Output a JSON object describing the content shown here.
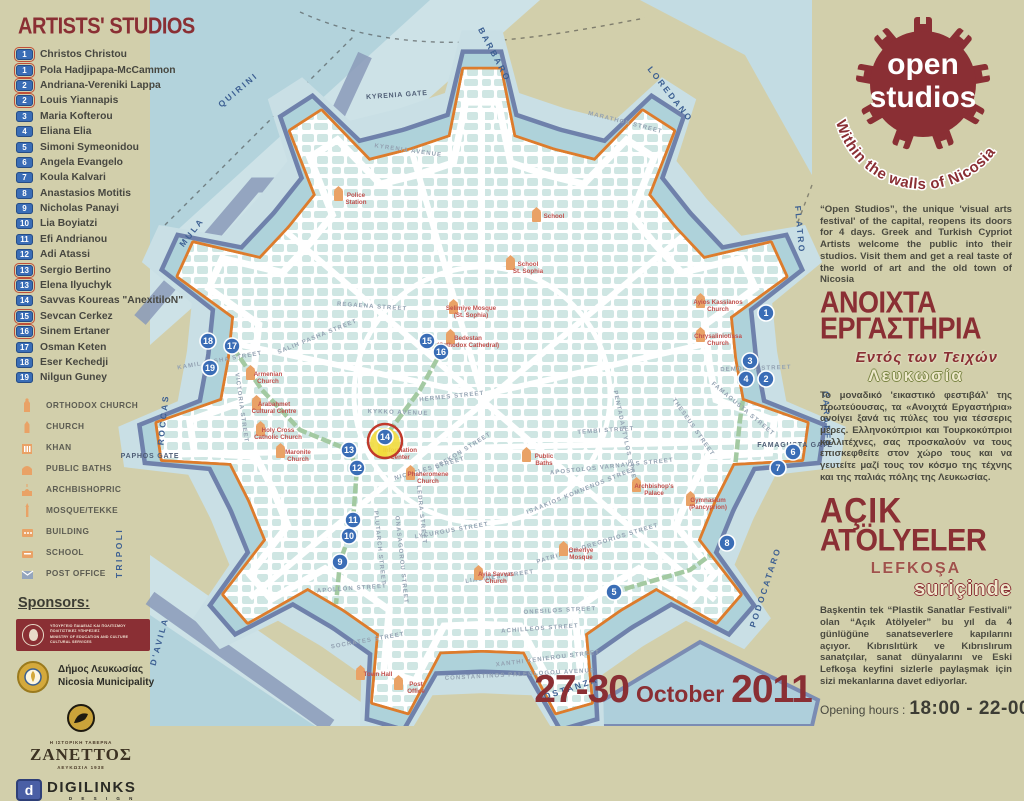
{
  "sidebar": {
    "title": "ARTISTS' STUDIOS",
    "studios": [
      {
        "num": "1",
        "name": "Christos Christou",
        "boxed": true
      },
      {
        "num": "1",
        "name": "Pola Hadjipapa-McCammon",
        "boxed": true
      },
      {
        "num": "2",
        "name": "Andriana-Vereniki Lappa",
        "boxed": true
      },
      {
        "num": "2",
        "name": "Louis Yiannapis",
        "boxed": true
      },
      {
        "num": "3",
        "name": "Maria Kofterou",
        "boxed": false
      },
      {
        "num": "4",
        "name": "Eliana Elia",
        "boxed": false
      },
      {
        "num": "5",
        "name": "Simoni Symeonidou",
        "boxed": false
      },
      {
        "num": "6",
        "name": "Angela  Evangelo",
        "boxed": false
      },
      {
        "num": "7",
        "name": "Koula Kalvari",
        "boxed": false
      },
      {
        "num": "8",
        "name": "Anastasios Motitis",
        "boxed": false
      },
      {
        "num": "9",
        "name": "Nicholas Panayi",
        "boxed": false
      },
      {
        "num": "10",
        "name": "Lia Boyiatzi",
        "boxed": false
      },
      {
        "num": "11",
        "name": "Efi Andrianou",
        "boxed": false
      },
      {
        "num": "12",
        "name": "Adi Atassi",
        "boxed": false
      },
      {
        "num": "13",
        "name": "Sergio Bertino",
        "boxed": true
      },
      {
        "num": "13",
        "name": "Elena Ilyuchyk",
        "boxed": true
      },
      {
        "num": "14",
        "name": "Savvas Koureas \"AnexitiloN\"",
        "boxed": false
      },
      {
        "num": "15",
        "name": "Sevcan Cerkez",
        "boxed": true
      },
      {
        "num": "16",
        "name": "Sinem Ertaner",
        "boxed": true
      },
      {
        "num": "17",
        "name": "Osman Keten",
        "boxed": false
      },
      {
        "num": "18",
        "name": "Eser Kechedji",
        "boxed": false
      },
      {
        "num": "19",
        "name": "Nilgun Guney",
        "boxed": false
      }
    ],
    "legend": [
      {
        "icon": "orthodox-church-icon",
        "label": "ORTHODOX CHURCH"
      },
      {
        "icon": "church-icon",
        "label": "CHURCH"
      },
      {
        "icon": "khan-icon",
        "label": "KHAN"
      },
      {
        "icon": "public-baths-icon",
        "label": "PUBLIC BATHS"
      },
      {
        "icon": "archbishopric-icon",
        "label": "ARCHBISHOPRIC"
      },
      {
        "icon": "mosque-tekke-icon",
        "label": "MOSQUE/TEKKE"
      },
      {
        "icon": "building-icon",
        "label": "BUILDING"
      },
      {
        "icon": "school-icon",
        "label": "SCHOOL"
      },
      {
        "icon": "post-office-icon",
        "label": "POST OFFICE"
      }
    ],
    "sponsors_title": "Sponsors:",
    "ministry_lines": [
      "ΥΠΟΥΡΓΕΙΟ ΠΑΙΔΕΙΑΣ ΚΑΙ ΠΟΛΙΤΙΣΜΟΥ",
      "ΠΟΛΙΤΙΣΤΙΚΕΣ ΥΠΗΡΕΣΙΕΣ",
      "MINISTRY OF EDUCATION AND CULTURE",
      "CULTURAL SERVICES"
    ],
    "municipality_lines": [
      "Δήμος Λευκωσίας",
      "Nicosia Municipality"
    ],
    "zanettos_lines": [
      "Η ΙΣΤΟΡΙΚΗ ΤΑΒΕΡΝΑ",
      "ΖΑΝΕΤΤΟΣ",
      "ΛΕΥΚΩΣΙΑ 1938"
    ],
    "digilinks_lines": [
      "DIGILINKS",
      "D E S I G N",
      "d"
    ]
  },
  "logo": {
    "line1": "open",
    "line2": "studios",
    "arc": "Within the walls of Nicosia"
  },
  "right": {
    "intro_en": "“Open Studios”, the unique 'visual arts festival' of the capital, reopens its doors for 4 days. Greek and Turkish Cypriot Artists welcome the public into their studios. Visit them and get a real taste of the world of art and the old town of Nicosia",
    "heading_el_1": "ΑΝΟΙΧΤΑ",
    "heading_el_2": "ΕΡΓΑΣΤΗΡΙΑ",
    "sub_el_1": "Εντός των Τειχών",
    "sub_el_2": "Λευκωσία",
    "body_el": "Το μοναδικό 'εικαστικό φεστιβάλ' της πρωτεύουσας, τα «Ανοιχτά Εργαστήρια» ανοίγει ξανά τις πύλες του για τέσσερις μέρες. Ελληνοκύπριοι και Τουρκοκύπριοι καλλιτέχνες, σας προσκαλούν να τους επισκεφθείτε στον χώρο τους και να γευτείτε μαζί τους τον κόσμο της τέχνης και της παλιάς πόλης της Λευκωσίας.",
    "heading_tr_1": "AÇIK",
    "heading_tr_2": "ATÖLYELER",
    "sub_tr_1": "LEFKOŞA",
    "sub_tr_2": "suriçinde",
    "body_tr": "Başkentin tek “Plastik Sanatlar Festivali” olan “Açık Atölyeler” bu yıl da 4 günlüğüne sanatseverlere kapılarını açıyor. Kıbrıslıtürk ve Kıbrıslırum sanatçılar, sanat dünyalarını ve Eski Lefkoşa keyfini sizlerle paylaşmak için sizi mekanlarına davet ediyorlar.",
    "hours_label": "Opening hours :",
    "hours_value": "18:00 - 22-00"
  },
  "footer": {
    "date_part1": "27-30",
    "date_part2": "October",
    "date_part3": "2011"
  },
  "colors": {
    "background": "#d2cfab",
    "maroon": "#8a2f34",
    "wall_orange": "#dd7c2c",
    "moat_blue": "#aed2da",
    "rim_blue": "#6f81ab",
    "block_teal": "#cfe6e3",
    "marker_blue": "#3a6db6",
    "poi_orange": "#e9a266",
    "poi_label_red": "#c0504d",
    "green_route": "#9fc79d",
    "highlight_yellow": "#f2dc3e"
  },
  "map": {
    "bastions": [
      {
        "label": "BARBARO",
        "x": 492,
        "y": 56,
        "r": 62
      },
      {
        "label": "QUIRINI",
        "x": 240,
        "y": 92,
        "r": -40
      },
      {
        "label": "LOREDANO",
        "x": 668,
        "y": 96,
        "r": 52
      },
      {
        "label": "FLATRO",
        "x": 797,
        "y": 230,
        "r": 85
      },
      {
        "label": "CARAFFA",
        "x": 824,
        "y": 420,
        "r": 88
      },
      {
        "label": "PODOCATARO",
        "x": 768,
        "y": 588,
        "r": -72
      },
      {
        "label": "COSTANZA",
        "x": 568,
        "y": 692,
        "r": -18
      },
      {
        "label": "D'AVILA",
        "x": 162,
        "y": 642,
        "r": -75
      },
      {
        "label": "TRIPOLI",
        "x": 122,
        "y": 553,
        "r": -90
      },
      {
        "label": "ROCCAS",
        "x": 166,
        "y": 420,
        "r": -84
      },
      {
        "label": "MULA",
        "x": 194,
        "y": 234,
        "r": -52
      }
    ],
    "gates": [
      {
        "label": "KYRENIA GATE",
        "x": 397,
        "y": 97,
        "r": -4
      },
      {
        "label": "PAPHOS GATE",
        "x": 150,
        "y": 458,
        "r": 0
      },
      {
        "label": "FAMAGUSTA GATE",
        "x": 795,
        "y": 447,
        "r": 0
      }
    ],
    "streets": [
      {
        "label": "KYRENIA AVENUE",
        "x": 408,
        "y": 152,
        "r": 8
      },
      {
        "label": "MARATHON STREET",
        "x": 625,
        "y": 124,
        "r": 14
      },
      {
        "label": "REGAENA STREET",
        "x": 372,
        "y": 308,
        "r": 4
      },
      {
        "label": "HERMES STREET",
        "x": 452,
        "y": 398,
        "r": -6
      },
      {
        "label": "KYKKO AVENUE",
        "x": 398,
        "y": 414,
        "r": 2
      },
      {
        "label": "NICOCLES STREET",
        "x": 430,
        "y": 470,
        "r": -16
      },
      {
        "label": "LEFKON STREET",
        "x": 464,
        "y": 452,
        "r": -32
      },
      {
        "label": "LYCURGUS STREET",
        "x": 452,
        "y": 532,
        "r": -10
      },
      {
        "label": "PLUTARCH STREET",
        "x": 378,
        "y": 548,
        "r": 84
      },
      {
        "label": "LEDRA STREET",
        "x": 420,
        "y": 515,
        "r": 84
      },
      {
        "label": "ONASAGOROU STREET",
        "x": 400,
        "y": 560,
        "r": 84
      },
      {
        "label": "APOLLON STREET",
        "x": 352,
        "y": 590,
        "r": -4
      },
      {
        "label": "SOCRATES STREET",
        "x": 368,
        "y": 642,
        "r": -10
      },
      {
        "label": "ACHILLEOS STREET",
        "x": 540,
        "y": 630,
        "r": -4
      },
      {
        "label": "XANTHI XENIEROU STREET",
        "x": 548,
        "y": 660,
        "r": -7
      },
      {
        "label": "CONSTANTINOS PALEOLOGOU AVENUE",
        "x": 520,
        "y": 676,
        "r": -3
      },
      {
        "label": "ONESILOS STREET",
        "x": 560,
        "y": 612,
        "r": -3
      },
      {
        "label": "LIASIDES STREET",
        "x": 500,
        "y": 578,
        "r": -8
      },
      {
        "label": "PATRIARCH GREGORIOS STREET",
        "x": 598,
        "y": 545,
        "r": -17
      },
      {
        "label": "ISAAKIOS KOMNENOS STREET",
        "x": 582,
        "y": 492,
        "r": -22
      },
      {
        "label": "APOSTOLOS VARNAVAS STREET",
        "x": 612,
        "y": 468,
        "r": -6
      },
      {
        "label": "TEMBI STREET",
        "x": 606,
        "y": 432,
        "r": -4
      },
      {
        "label": "PENTADAKTYLOS STREET",
        "x": 624,
        "y": 440,
        "r": 78
      },
      {
        "label": "THESEUS STREET",
        "x": 692,
        "y": 428,
        "r": 55
      },
      {
        "label": "FAMAGUSTA STREET",
        "x": 742,
        "y": 410,
        "r": 40
      },
      {
        "label": "DEMONAX STREET",
        "x": 756,
        "y": 370,
        "r": -2
      },
      {
        "label": "SALIH PASHA STREET",
        "x": 318,
        "y": 338,
        "r": -22
      },
      {
        "label": "KAMIL PASHA STREET",
        "x": 220,
        "y": 362,
        "r": -10
      },
      {
        "label": "VICTORIA STREET",
        "x": 240,
        "y": 408,
        "r": 82
      }
    ],
    "pois": [
      {
        "l1": "Selimiye Mosque",
        "l2": "(St. Sophia)",
        "x": 465,
        "y": 316
      },
      {
        "l1": "Bedestan",
        "l2": "(Orthodox Cathedral)",
        "x": 462,
        "y": 346
      },
      {
        "l1": "School",
        "l2": "St. Sophia",
        "x": 522,
        "y": 272
      },
      {
        "l1": "School",
        "l2": "",
        "x": 548,
        "y": 224
      },
      {
        "l1": "Police",
        "l2": "Station",
        "x": 350,
        "y": 203
      },
      {
        "l1": "Phaneromene",
        "l2": "Church",
        "x": 422,
        "y": 482
      },
      {
        "l1": "Public",
        "l2": "Baths",
        "x": 538,
        "y": 464
      },
      {
        "l1": "Omeriye",
        "l2": "Mosque",
        "x": 575,
        "y": 558
      },
      {
        "l1": "Archbishop's",
        "l2": "Palace",
        "x": 648,
        "y": 494
      },
      {
        "l1": "Gymnasium",
        "l2": "(Pancyprion)",
        "x": 702,
        "y": 508
      },
      {
        "l1": "Ayios Kassianos",
        "l2": "Church",
        "x": 712,
        "y": 310
      },
      {
        "l1": "Chrysaliniotissa",
        "l2": "Church",
        "x": 712,
        "y": 344
      },
      {
        "l1": "Armenian",
        "l2": "Church",
        "x": 262,
        "y": 382
      },
      {
        "l1": "Arabahmet",
        "l2": "Cultural Centre",
        "x": 268,
        "y": 412
      },
      {
        "l1": "Holy Cross",
        "l2": "Catholic Church",
        "x": 272,
        "y": 438
      },
      {
        "l1": "Maronite",
        "l2": "Church",
        "x": 292,
        "y": 460
      },
      {
        "l1": "Ayia Savvas",
        "l2": "Church",
        "x": 490,
        "y": 582
      },
      {
        "l1": "Town Hall",
        "l2": "",
        "x": 372,
        "y": 682
      },
      {
        "l1": "Post",
        "l2": "Office",
        "x": 410,
        "y": 692
      },
      {
        "l1": "Information",
        "l2": "Center",
        "x": 394,
        "y": 458,
        "info": true
      }
    ],
    "markers": [
      {
        "n": "1",
        "x": 766,
        "y": 313
      },
      {
        "n": "2",
        "x": 766,
        "y": 379
      },
      {
        "n": "3",
        "x": 750,
        "y": 361
      },
      {
        "n": "4",
        "x": 746,
        "y": 379
      },
      {
        "n": "5",
        "x": 614,
        "y": 592
      },
      {
        "n": "6",
        "x": 793,
        "y": 452
      },
      {
        "n": "7",
        "x": 778,
        "y": 468
      },
      {
        "n": "8",
        "x": 727,
        "y": 543
      },
      {
        "n": "9",
        "x": 340,
        "y": 562
      },
      {
        "n": "10",
        "x": 349,
        "y": 536
      },
      {
        "n": "11",
        "x": 353,
        "y": 520
      },
      {
        "n": "12",
        "x": 357,
        "y": 468
      },
      {
        "n": "13",
        "x": 349,
        "y": 450
      },
      {
        "n": "14",
        "x": 385,
        "y": 437,
        "hl": true
      },
      {
        "n": "15",
        "x": 427,
        "y": 341
      },
      {
        "n": "16",
        "x": 441,
        "y": 352
      },
      {
        "n": "17",
        "x": 232,
        "y": 346
      },
      {
        "n": "18",
        "x": 208,
        "y": 341
      },
      {
        "n": "19",
        "x": 210,
        "y": 368
      }
    ]
  }
}
